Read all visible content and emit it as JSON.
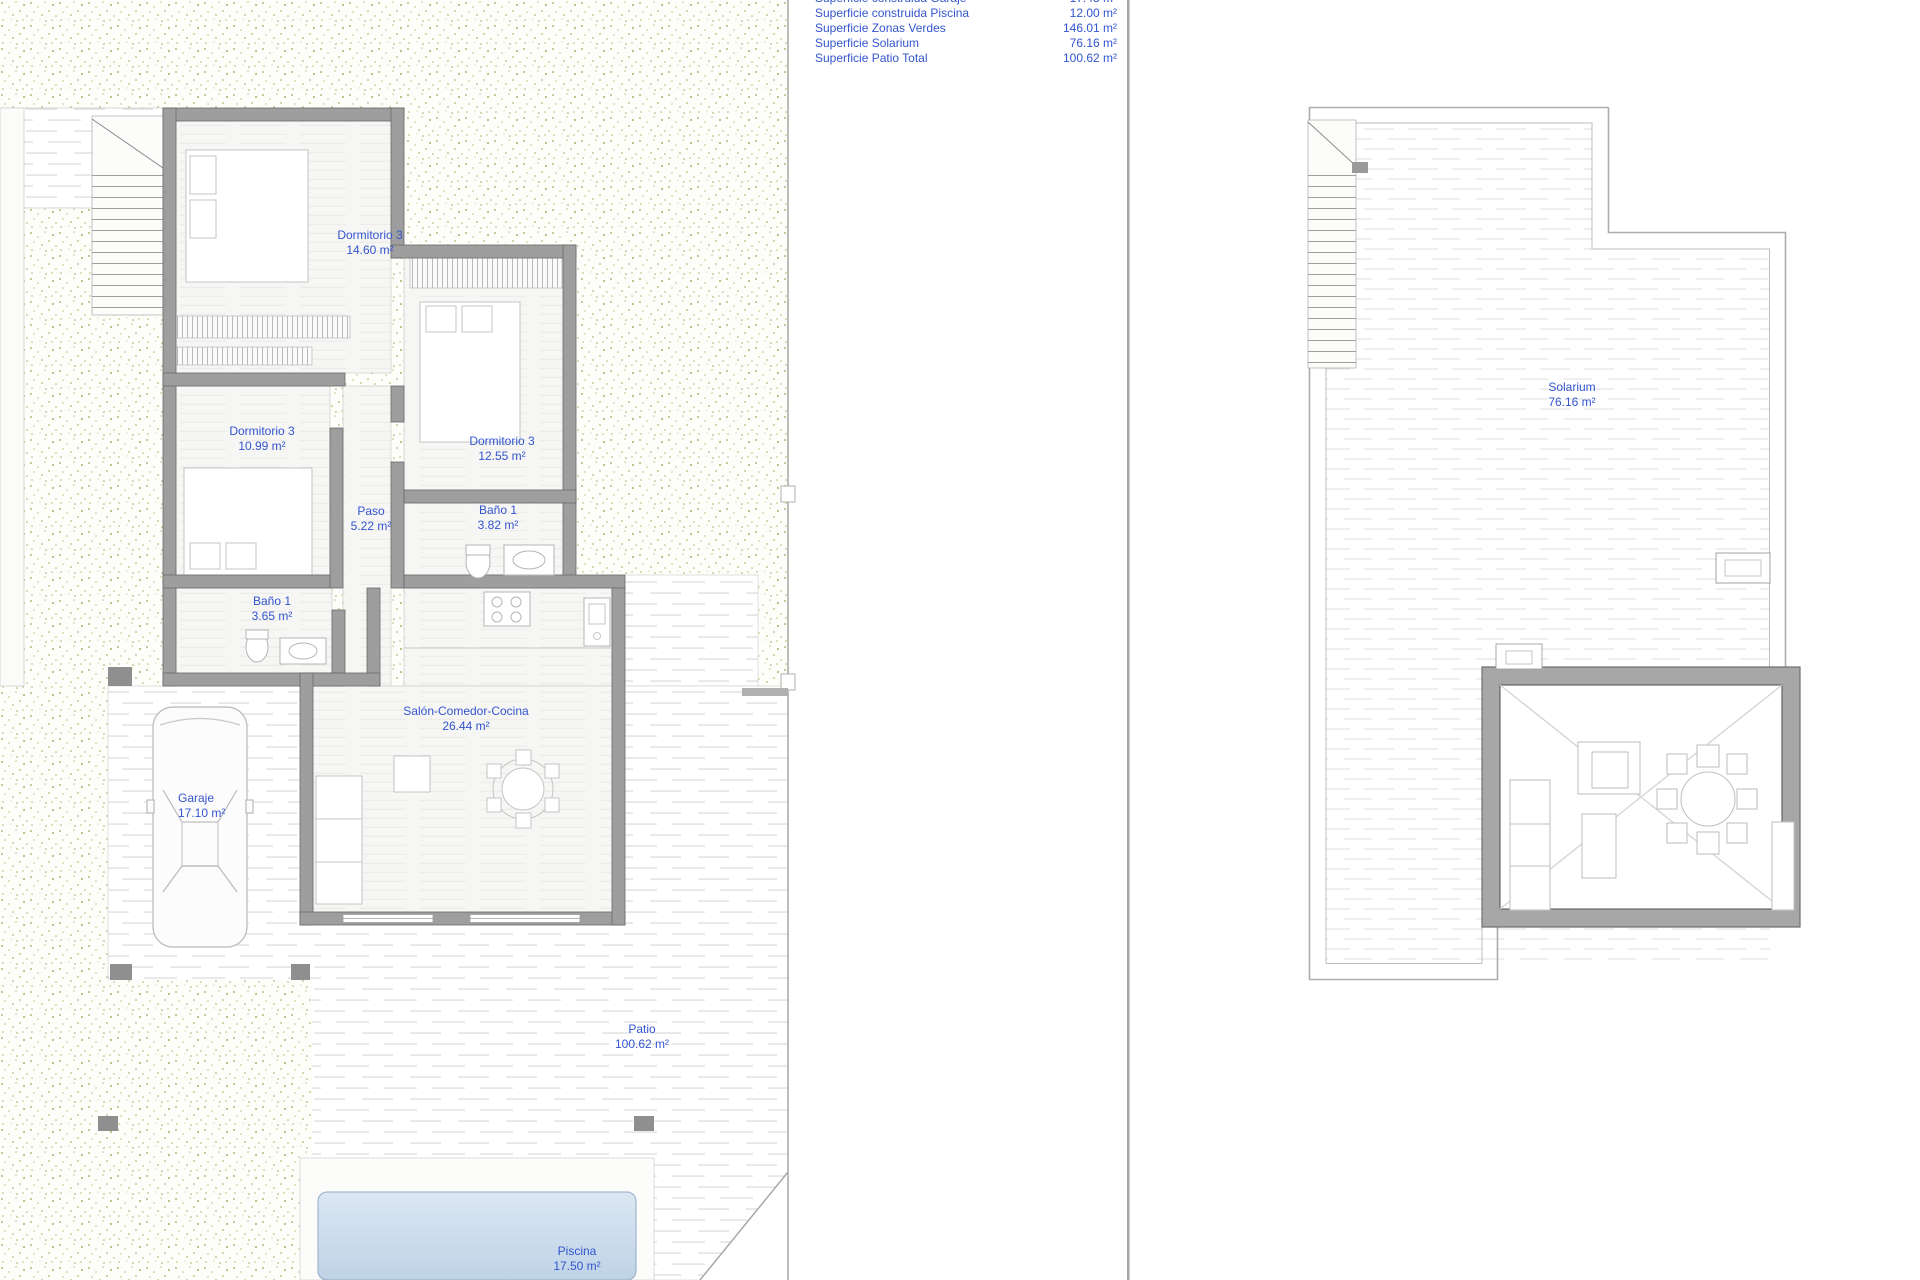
{
  "legend": {
    "rows": [
      {
        "label": "Superficie construida Garaje",
        "value": "17.48 m²"
      },
      {
        "label": "Superficie construida Piscina",
        "value": "12.00 m²"
      },
      {
        "label": "Superficie Zonas Verdes",
        "value": "146.01 m²"
      },
      {
        "label": "Superficie Solarium",
        "value": "76.16 m²"
      },
      {
        "label": "Superficie Patio Total",
        "value": "100.62 m²"
      }
    ]
  },
  "ground_floor": {
    "rooms": [
      {
        "name": "Dormitorio 3",
        "area": "14.60 m²"
      },
      {
        "name": "Dormitorio 3",
        "area": "10.99 m²"
      },
      {
        "name": "Dormitorio 3",
        "area": "12.55 m²"
      },
      {
        "name": "Paso",
        "area": "5.22 m²"
      },
      {
        "name": "Baño 1",
        "area": "3.82 m²"
      },
      {
        "name": "Baño 1",
        "area": "3.65 m²"
      },
      {
        "name": "Salón-Comedor-Cocina",
        "area": "26.44 m²"
      },
      {
        "name": "Garaje",
        "area": "17.10 m²"
      },
      {
        "name": "Patio",
        "area": "100.62 m²"
      },
      {
        "name": "Piscina",
        "area": "17.50 m²"
      }
    ]
  },
  "roof": {
    "rooms": [
      {
        "name": "Solarium",
        "area": "76.16 m²"
      }
    ]
  },
  "colors": {
    "label_blue": "#3355cf",
    "wall_gray": "#9e9e9e",
    "greenery_dot": "#a9c17c",
    "pool_blue": "#c9d9ea"
  }
}
